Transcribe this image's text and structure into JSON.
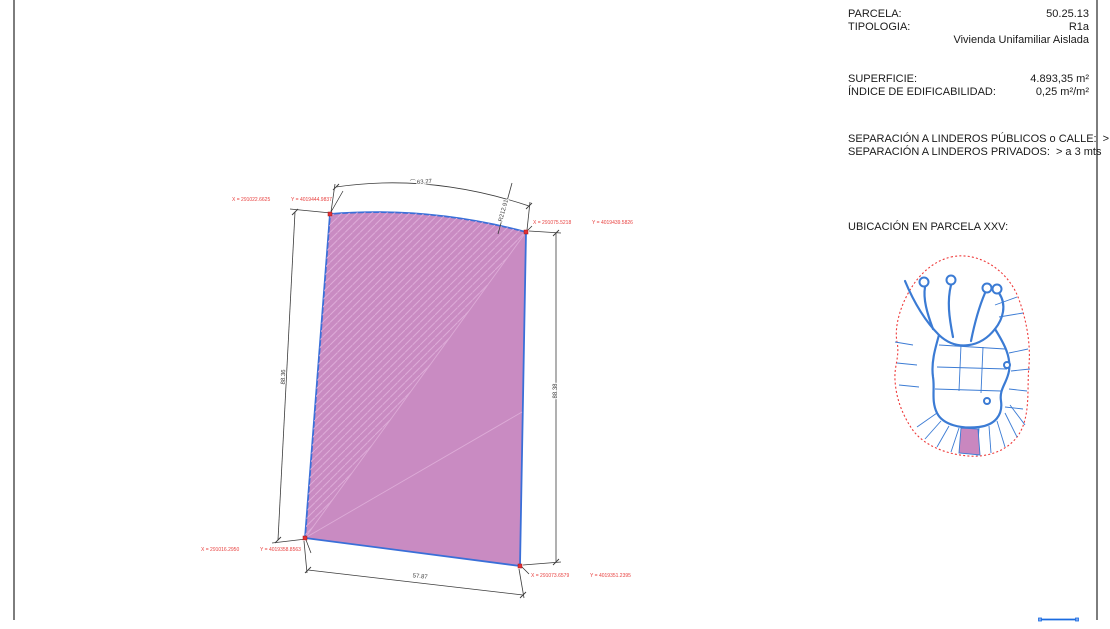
{
  "colors": {
    "parcel-fill": "#c98bc2",
    "parcel-stroke": "#3a6fd8",
    "hatch": "#ddabd7",
    "marker-red": "#e03236",
    "coord-red": "#e8403f",
    "dim-line": "#3b3b3b",
    "frame-gray": "#7d7d7d",
    "map-road-blue": "#3b7bd4",
    "map-boundary-red": "#ee3a3a",
    "map-parcel-fill": "#c987bf",
    "handle-blue": "#1a6be0"
  },
  "info_panel": {
    "rows": [
      {
        "label": "PARCELA:",
        "value": "50.25.13"
      },
      {
        "label": "TIPOLOGIA:",
        "value": "R1a"
      },
      {
        "label": "",
        "value": "Vivienda Unifamiliar Aislada"
      },
      {
        "label": "SUPERFICIE:",
        "value": "4.893,35 m²"
      },
      {
        "label": "ÍNDICE DE EDIFICABILIDAD:",
        "value": "0,25 m²/m²"
      },
      {
        "label": "SEPARACIÓN A LINDEROS PÚBLICOS o CALLE:",
        "value": "> a 6 mts"
      },
      {
        "label": "SEPARACIÓN A LINDEROS PRIVADOS:",
        "value": "> a 3 mts"
      }
    ],
    "ubicacion_label": "UBICACIÓN EN PARCELA XXV:"
  },
  "plan": {
    "vertices": [
      {
        "position": "top-left",
        "x_label": "X = 291022.6625",
        "y_label": "Y = 4019444.9837"
      },
      {
        "position": "top-right",
        "x_label": "X = 291075.5218",
        "y_label": "Y = 4019439.5826"
      },
      {
        "position": "bottom-left",
        "x_label": "X = 291016.2950",
        "y_label": "Y = 4019358.8563"
      },
      {
        "position": "bottom-right",
        "x_label": "X = 291073.6579",
        "y_label": "Y = 4019351.2395"
      }
    ],
    "dimensions": {
      "top_arc_symbol": "⌒",
      "top_arc": "63.27",
      "radius": "R212.91",
      "left_side": "88.36",
      "right_side": "88.38",
      "bottom_side": "57.87"
    }
  }
}
